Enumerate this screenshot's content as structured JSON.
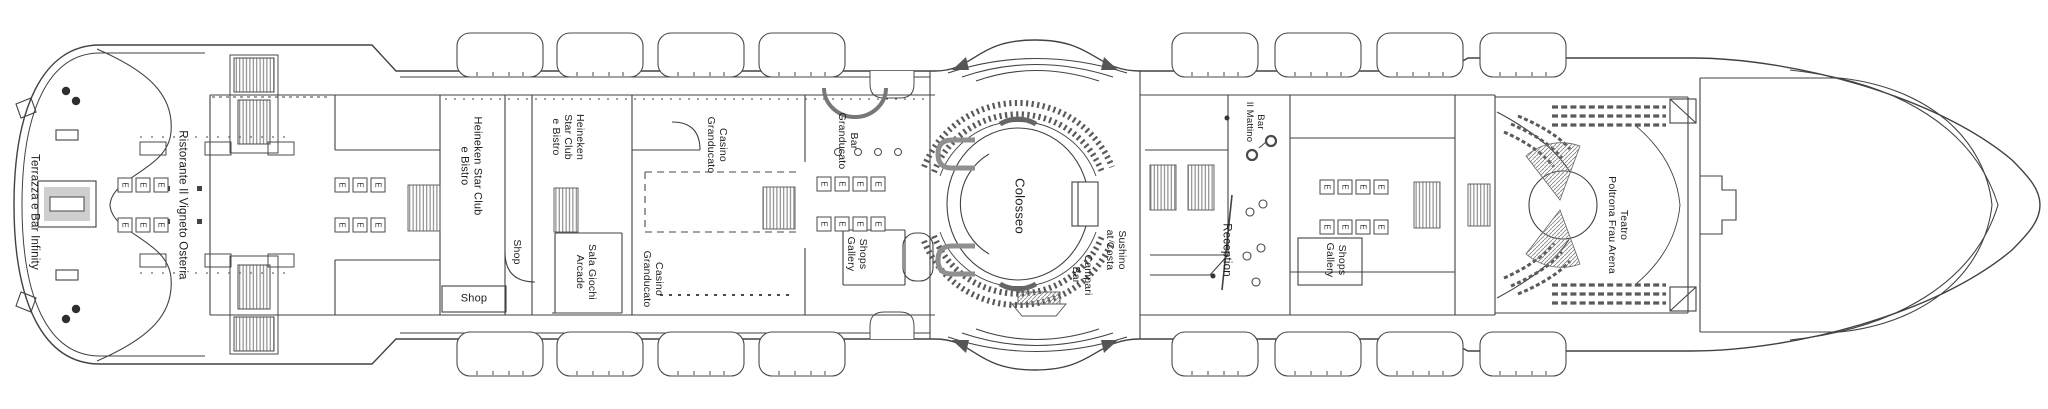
{
  "deck": {
    "type": "cruise-ship-deck-plan",
    "colors": {
      "background": "#ffffff",
      "line": "#424242",
      "hatch": "#7a7a7a",
      "seat": "#5a5a5a",
      "text": "#1c1c1c",
      "gray_fill": "#cfcfcf"
    }
  },
  "symbols": {
    "elevator_glyph": "E"
  },
  "labels": [
    {
      "id": "terrazza-e-bar-infinity",
      "text": "Terrazza e Bar Infinity"
    },
    {
      "id": "ristorante-il-vigneto-osteria",
      "text": "Ristorante Il Vigneto Osteria"
    },
    {
      "id": "heineken-star-club-aft",
      "text": "Heineken Star Club\ne Bistro"
    },
    {
      "id": "heineken-star-club-fwd",
      "text": "Heineken\nStar Club\ne Bistro"
    },
    {
      "id": "shop-mid",
      "text": "Shop"
    },
    {
      "id": "shop-lower",
      "text": "Shop"
    },
    {
      "id": "sala-giochi-arcade",
      "text": "Sala Giochi\nArcade"
    },
    {
      "id": "casino-granducato-port",
      "text": "Casino\nGranducato"
    },
    {
      "id": "casino-granducato-starboard",
      "text": "Casino\nGranducato"
    },
    {
      "id": "bar-granducato",
      "text": "Bar\nGranducato"
    },
    {
      "id": "shops-gallery-mid",
      "text": "Shops\nGallery"
    },
    {
      "id": "colosseo",
      "text": "Colosseo"
    },
    {
      "id": "campari-bar",
      "text": "Campari\nBar"
    },
    {
      "id": "sushino-at-costa",
      "text": "Sushino\nat Costa"
    },
    {
      "id": "reception",
      "text": "Reception"
    },
    {
      "id": "bar-il-mattino",
      "text": "Bar\nIl Mattino"
    },
    {
      "id": "shops-gallery-fwd",
      "text": "Shops\nGallery"
    },
    {
      "id": "teatro-poltrona-frau-arena",
      "text": "Teatro\nPoltrona Frau Arena"
    }
  ]
}
